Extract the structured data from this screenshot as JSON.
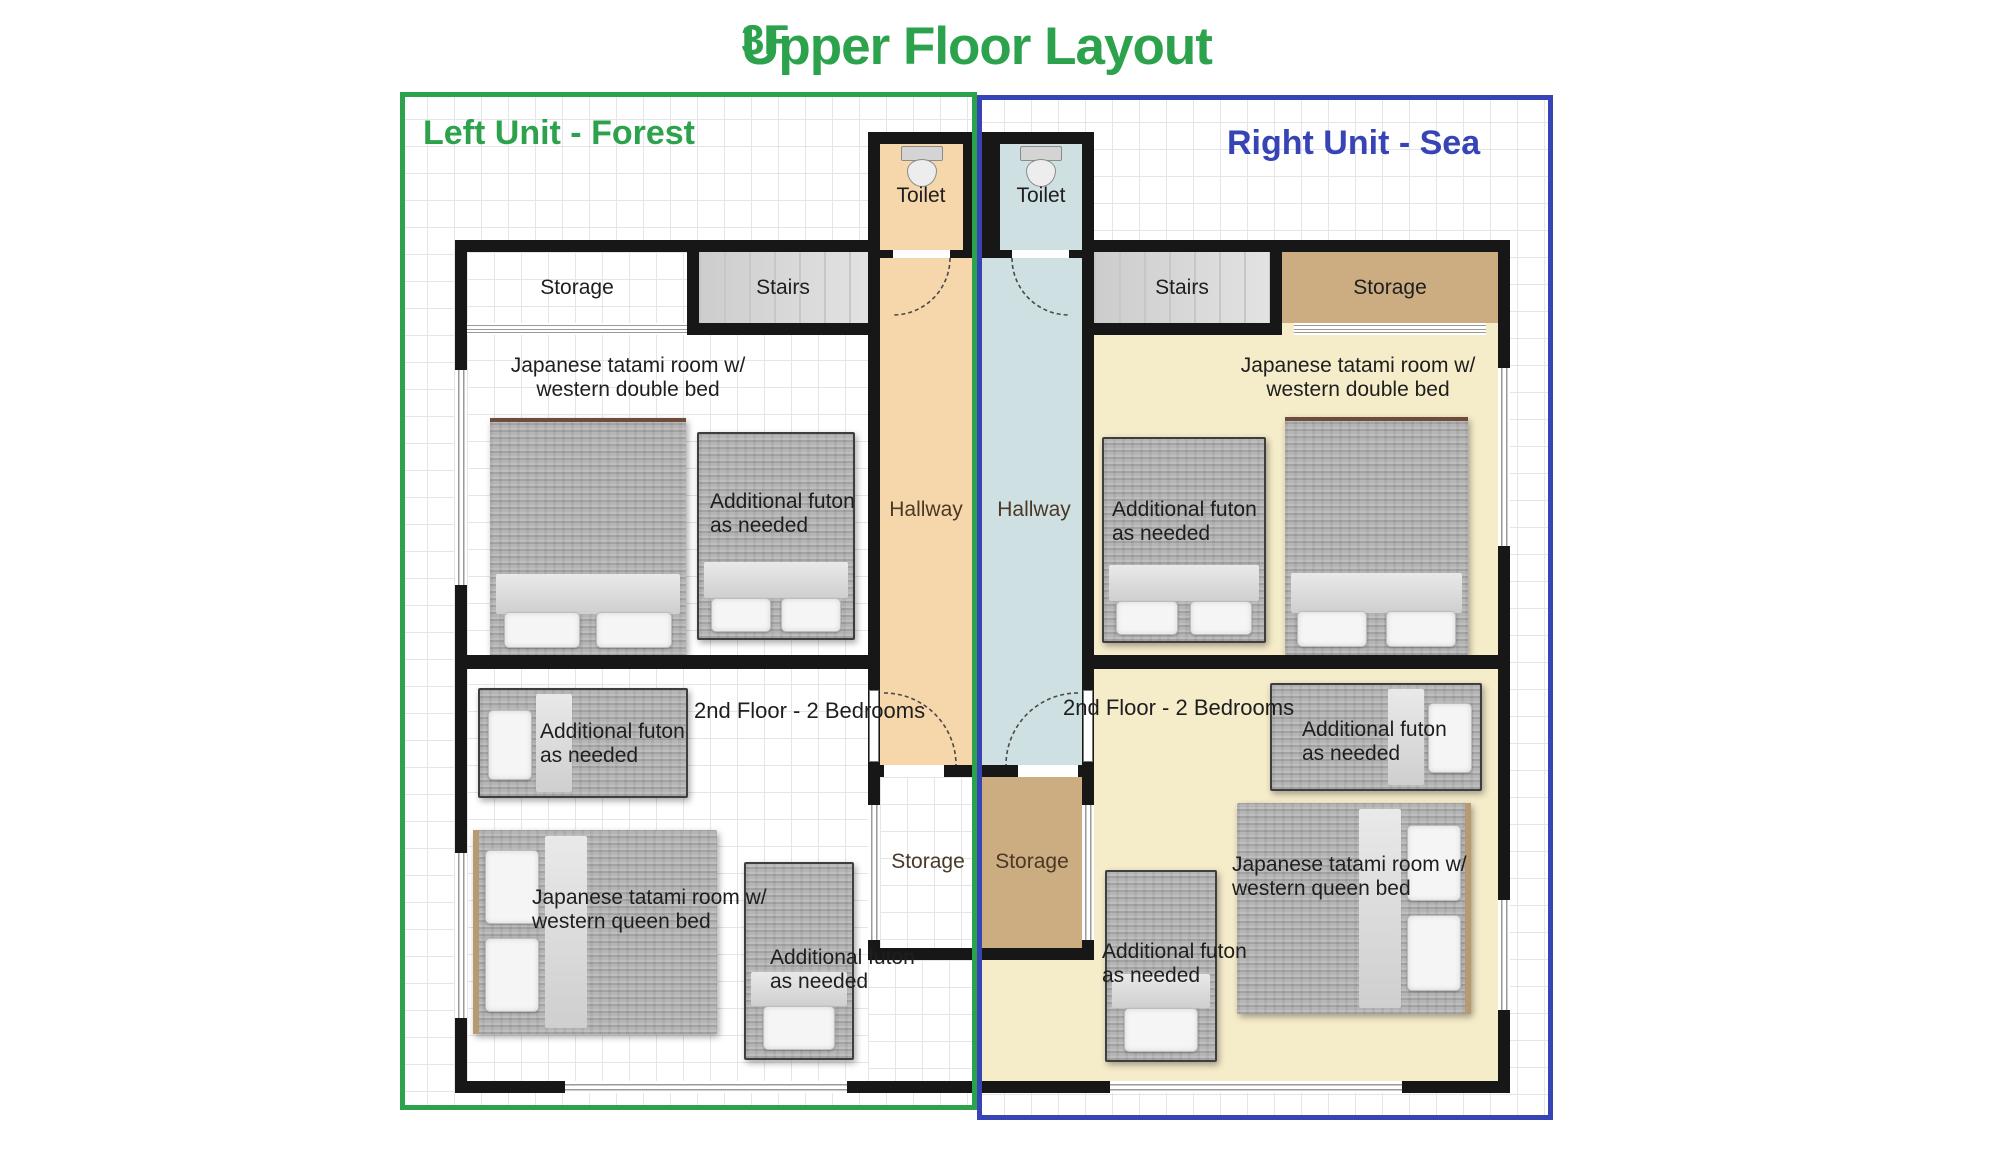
{
  "title": {
    "floor": "3F",
    "text": "Upper Floor Layout"
  },
  "units": {
    "left": {
      "label": "Left Unit - Forest"
    },
    "right": {
      "label": "Right Unit - Sea"
    }
  },
  "labels": {
    "toilet": "Toilet",
    "hallway": "Hallway",
    "storage": "Storage",
    "stairs": "Stairs",
    "second_floor": "2nd Floor - 2 Bedrooms",
    "futon": {
      "line1": "Additional futon",
      "line2": "as needed"
    },
    "tatami_double": {
      "line1": "Japanese tatami room w/",
      "line2": "western double bed"
    },
    "tatami_queen": {
      "line1": "Japanese tatami room w/",
      "line2": "western queen bed"
    }
  },
  "colors": {
    "accent_green": "#2ca24c",
    "accent_blue": "#3644b5",
    "wall": "#171717",
    "hall_peach": "#f6d7ab",
    "hall_blue": "#cfe0e2",
    "floor_cream": "#f5ecca",
    "storage_tan": "#ccad81",
    "stairs_gray": "#dcdcdc",
    "bed_gray": "#b5b5b5",
    "grid_line": "#e5e5e8",
    "label_dark": "#1e1e1e",
    "hall_label_brown": "#4a3926"
  }
}
